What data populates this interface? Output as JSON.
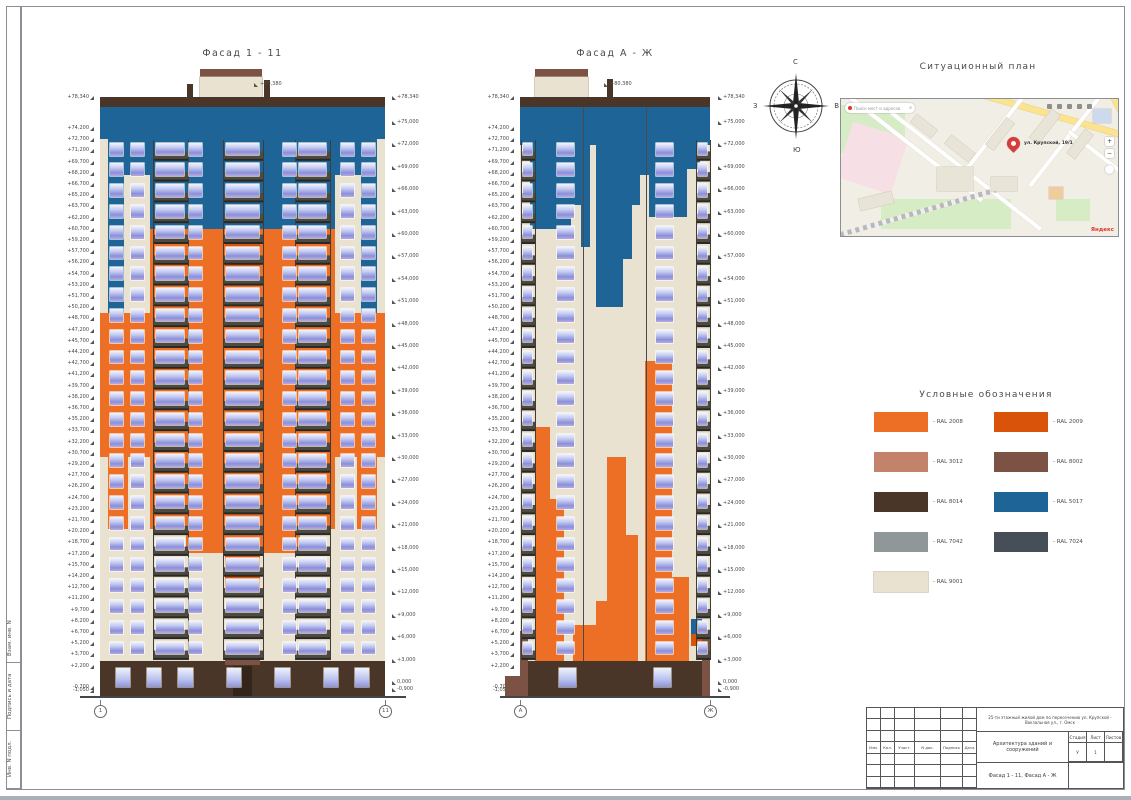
{
  "sheet": {
    "facade1_title": "Фасад 1 - 11",
    "facade2_title": "Фасад А - Ж",
    "map_title": "Ситуационный план",
    "legend_title": "Условные обозначения"
  },
  "colors": {
    "ral2008": "#ec6f25",
    "ral2009": "#d9530a",
    "ral3012": "#c2836a",
    "ral8002": "#7b5244",
    "ral8014": "#4a3628",
    "ral5017": "#1e6496",
    "ral7042": "#8f9798",
    "ral7024": "#464e57",
    "ral9001": "#eae2d1",
    "line": "#4b4b4b",
    "door": "#33251a"
  },
  "elevations": {
    "top": "+80,380",
    "left": [
      "+78,340",
      "+74,200",
      "+72,700",
      "+71,200",
      "+69,700",
      "+68,200",
      "+66,700",
      "+65,200",
      "+63,700",
      "+62,200",
      "+60,700",
      "+59,200",
      "+57,700",
      "+56,200",
      "+54,700",
      "+53,200",
      "+51,700",
      "+50,200",
      "+48,700",
      "+47,200",
      "+45,700",
      "+44,200",
      "+42,700",
      "+41,200",
      "+39,700",
      "+38,200",
      "+36,700",
      "+35,200",
      "+33,700",
      "+32,200",
      "+30,700",
      "+29,200",
      "+27,700",
      "+26,200",
      "+24,700",
      "+23,200",
      "+21,700",
      "+20,200",
      "+18,700",
      "+17,200",
      "+15,700",
      "+14,200",
      "+12,700",
      "+11,200",
      "+9,700",
      "+8,200",
      "+6,700",
      "+5,200",
      "+3,700",
      "+2,200",
      "-0,700",
      "-1,050"
    ],
    "right": [
      "+78,340",
      "+75,000",
      "+72,000",
      "+69,000",
      "+66,000",
      "+63,000",
      "+60,000",
      "+57,000",
      "+54,000",
      "+51,000",
      "+48,000",
      "+45,000",
      "+42,000",
      "+39,000",
      "+36,000",
      "+33,000",
      "+30,000",
      "+27,000",
      "+24,000",
      "+21,000",
      "+18,000",
      "+15,000",
      "+12,000",
      "+9,000",
      "+6,000",
      "+3,000",
      "0,000",
      "-0,900"
    ]
  },
  "facades": [
    {
      "id": "f1",
      "title": "Фасад 1 - 11",
      "axis_left": "1",
      "axis_right": "11",
      "rows": 25,
      "win": {
        "top": 7.2,
        "bot": 93.8,
        "w": 4.6
      },
      "cols": [
        5.8,
        13.2,
        33.5,
        66.5,
        86.8,
        94.2
      ],
      "balconies": [
        {
          "x": 18.5,
          "w": 12
        },
        {
          "x": 43,
          "w": 14
        },
        {
          "x": 68.5,
          "w": 12
        }
      ],
      "baseW": 5,
      "baseWins": [
        8,
        19,
        30,
        47,
        64,
        81,
        92
      ],
      "blocks": [
        {
          "x": 35,
          "y": -4.6,
          "w": 22,
          "h": 1.2,
          "c": "ral8002"
        },
        {
          "x": 35,
          "y": -3.4,
          "w": 22,
          "h": 3.5,
          "c": "ral9001",
          "o": 1
        },
        {
          "x": 30.5,
          "y": -2.2,
          "w": 2.2,
          "h": 2.2,
          "c": "ral8014"
        },
        {
          "x": 57.5,
          "y": -2.8,
          "w": 2.2,
          "h": 2.8,
          "c": "ral8014"
        },
        {
          "x": 0,
          "y": 0,
          "w": 100,
          "h": 1.6,
          "c": "ral8014"
        },
        {
          "x": 0,
          "y": 1.6,
          "w": 100,
          "h": 5.4,
          "c": "ral5017"
        },
        {
          "x": 2.8,
          "y": 7,
          "w": 5.6,
          "h": 29,
          "c": "ral5017"
        },
        {
          "x": 8.4,
          "y": 7,
          "w": 9,
          "h": 6,
          "c": "ral5017"
        },
        {
          "x": 17.4,
          "y": 7,
          "w": 6,
          "h": 17,
          "c": "ral5017"
        },
        {
          "x": 23.4,
          "y": 7,
          "w": 19,
          "h": 15,
          "c": "ral5017"
        },
        {
          "x": 42.4,
          "y": 7,
          "w": 15.2,
          "h": 20,
          "c": "ral5017"
        },
        {
          "x": 57.6,
          "y": 7,
          "w": 19,
          "h": 15,
          "c": "ral5017"
        },
        {
          "x": 76.6,
          "y": 7,
          "w": 6,
          "h": 17,
          "c": "ral5017"
        },
        {
          "x": 82.6,
          "y": 7,
          "w": 9,
          "h": 6,
          "c": "ral5017"
        },
        {
          "x": 91.6,
          "y": 7,
          "w": 5.6,
          "h": 29,
          "c": "ral5017"
        },
        {
          "x": 17.4,
          "y": 22,
          "w": 65.2,
          "h": 50,
          "c": "ral2008"
        },
        {
          "x": 0,
          "y": 36,
          "w": 17.4,
          "h": 24,
          "c": "ral2008"
        },
        {
          "x": 82.6,
          "y": 36,
          "w": 17.4,
          "h": 24,
          "c": "ral2008"
        },
        {
          "x": 2.8,
          "y": 60,
          "w": 7,
          "h": 12,
          "c": "ral2008"
        },
        {
          "x": 90.2,
          "y": 60,
          "w": 7,
          "h": 12,
          "c": "ral2008"
        },
        {
          "x": 30,
          "y": 72,
          "w": 40,
          "h": 4,
          "c": "ral2008"
        },
        {
          "x": 44,
          "y": 24,
          "w": 12,
          "h": 6,
          "c": "ral2009"
        },
        {
          "x": 44,
          "y": 76,
          "w": 12,
          "h": 6,
          "c": "ral2009"
        },
        {
          "x": 0,
          "y": 94,
          "w": 100,
          "h": 6,
          "c": "ral8014"
        },
        {
          "x": 44,
          "y": 93.2,
          "w": 12,
          "h": 1.4,
          "c": "ral8002"
        },
        {
          "x": 46.5,
          "y": 94.8,
          "w": 7,
          "h": 5.2,
          "c": "door"
        }
      ]
    },
    {
      "id": "f2",
      "title": "Фасад А - Ж",
      "axis_left": "А",
      "axis_right": "Ж",
      "rows": 25,
      "win": {
        "top": 7.2,
        "bot": 93.8,
        "w": 9
      },
      "cols": [
        24,
        76
      ],
      "balconies": [
        {
          "x": 0.5,
          "w": 7
        },
        {
          "x": 92.5,
          "w": 7
        }
      ],
      "baseW": 9,
      "baseWins": [
        25,
        75
      ],
      "blocks": [
        {
          "x": 8,
          "y": -4.6,
          "w": 28,
          "h": 1.2,
          "c": "ral8002"
        },
        {
          "x": 8,
          "y": -3.4,
          "w": 28,
          "h": 3.5,
          "c": "ral9001",
          "o": 1
        },
        {
          "x": 46,
          "y": -3,
          "w": 3,
          "h": 3,
          "c": "ral8014"
        },
        {
          "x": 0,
          "y": 0,
          "w": 100,
          "h": 1.6,
          "c": "ral8014"
        },
        {
          "x": 0,
          "y": 1.6,
          "w": 100,
          "h": 6.4,
          "c": "ral5017"
        },
        {
          "x": 5,
          "y": 8,
          "w": 22,
          "h": 14,
          "c": "ral5017"
        },
        {
          "x": 27,
          "y": 8,
          "w": 5,
          "h": 10,
          "c": "ral5017"
        },
        {
          "x": 32,
          "y": 8,
          "w": 5,
          "h": 17,
          "c": "ral5017"
        },
        {
          "x": 40,
          "y": 8,
          "w": 14,
          "h": 27,
          "c": "ral5017"
        },
        {
          "x": 54,
          "y": 8,
          "w": 5,
          "h": 19,
          "c": "ral5017"
        },
        {
          "x": 59,
          "y": 8,
          "w": 4,
          "h": 10,
          "c": "ral5017"
        },
        {
          "x": 63,
          "y": 8,
          "w": 5,
          "h": 5,
          "c": "ral5017"
        },
        {
          "x": 68,
          "y": 8,
          "w": 20,
          "h": 12,
          "c": "ral5017"
        },
        {
          "x": 88,
          "y": 8,
          "w": 7,
          "h": 4,
          "c": "ral5017"
        },
        {
          "x": 8,
          "y": 55,
          "w": 8,
          "h": 39,
          "c": "ral2008"
        },
        {
          "x": 16,
          "y": 67,
          "w": 7,
          "h": 27,
          "c": "ral2008"
        },
        {
          "x": 28,
          "y": 88,
          "w": 12,
          "h": 6,
          "c": "ral2008"
        },
        {
          "x": 46,
          "y": 60,
          "w": 10,
          "h": 34,
          "c": "ral2008"
        },
        {
          "x": 56,
          "y": 73,
          "w": 6,
          "h": 21,
          "c": "ral2008"
        },
        {
          "x": 66,
          "y": 44,
          "w": 14,
          "h": 50,
          "c": "ral2008"
        },
        {
          "x": 80,
          "y": 80,
          "w": 9,
          "h": 14,
          "c": "ral2008"
        },
        {
          "x": 40,
          "y": 84,
          "w": 6,
          "h": 10,
          "c": "ral2008"
        },
        {
          "x": 33.2,
          "y": 1.6,
          "w": 0.5,
          "h": 92.4,
          "c": "line"
        },
        {
          "x": 66.3,
          "y": 1.6,
          "w": 0.5,
          "h": 92.4,
          "c": "line"
        },
        {
          "x": 0,
          "y": 94,
          "w": 100,
          "h": 6,
          "c": "ral8014"
        },
        {
          "x": 0,
          "y": 89,
          "w": 4,
          "h": 11,
          "c": "ral8002"
        },
        {
          "x": 96,
          "y": 89,
          "w": 4,
          "h": 11,
          "c": "ral8002"
        },
        {
          "x": -8,
          "y": 96.5,
          "w": 8,
          "h": 3.5,
          "c": "ral8002"
        },
        {
          "x": 90,
          "y": 87,
          "w": 6,
          "h": 2.5,
          "c": "ral5017"
        },
        {
          "x": 90,
          "y": 89.5,
          "w": 6,
          "h": 2,
          "c": "ral2009"
        }
      ]
    }
  ],
  "compass": {
    "n": "С",
    "e": "В",
    "s": "Ю",
    "w": "З"
  },
  "map": {
    "search_placeholder": "Поиск мест и адресов",
    "pin_label": "ул. Крупской, 19/1",
    "zoom_in": "+",
    "zoom_out": "−",
    "logo": "Яндекс",
    "mag": "⌕"
  },
  "legend": {
    "items": [
      {
        "label": "- RAL 2008",
        "c": "ral2008"
      },
      {
        "label": "- RAL 2009",
        "c": "ral2009"
      },
      {
        "label": "- RAL 3012",
        "c": "ral3012"
      },
      {
        "label": "- RAL 8002",
        "c": "ral8002"
      },
      {
        "label": "- RAL 8014",
        "c": "ral8014"
      },
      {
        "label": "- RAL 5017",
        "c": "ral5017"
      },
      {
        "label": "- RAL 7042",
        "c": "ral7042"
      },
      {
        "label": "- RAL 7024",
        "c": "ral7024"
      },
      {
        "label": "- RAL 9001",
        "c": "ral9001"
      }
    ]
  },
  "titleblock": {
    "cols": [
      "Изм.",
      "Кол.",
      "Участ.",
      "N док.",
      "Подпись",
      "Дата"
    ],
    "project": "25-ти этажный жилой дом по пересечению ул. Крупской - Вокзальная ул., г. Омск",
    "doc": "Архитектура зданий и сооружений",
    "sheet_name": "Фасад 1 - 11, Фасад А - Ж",
    "stage_h": [
      "Стадия",
      "Лист",
      "Листов"
    ],
    "stage_v": [
      "У",
      "1",
      ""
    ]
  },
  "side_labels": [
    "Инв. N подл.",
    "Подпись и дата",
    "Взам. инв. N"
  ]
}
